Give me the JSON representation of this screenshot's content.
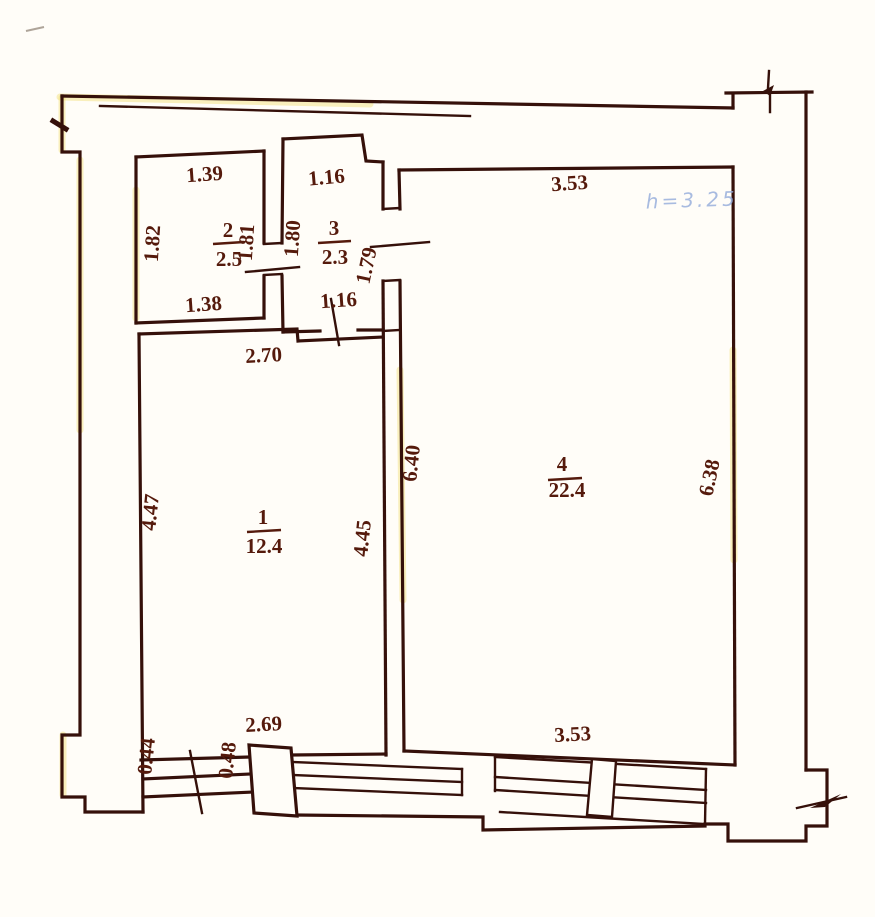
{
  "document": {
    "type": "apartment floor plan (BTI scan)"
  },
  "colors": {
    "ink": "#35100a",
    "dimension_text": "#551a0c",
    "height_note_blue": "#93abdb",
    "paper": "#fffdf8",
    "scan_highlight": "#f0dc6a"
  },
  "rooms": [
    {
      "number": "1",
      "area": "12.4",
      "dim_top": "2.70",
      "dim_left": "4.47",
      "dim_right": "4.45",
      "dim_bottom": "2.69"
    },
    {
      "number": "2",
      "area": "2.5",
      "dim_top": "1.39",
      "dim_left": "1.82",
      "dim_right": "1.81",
      "dim_bottom": "1.38"
    },
    {
      "number": "3",
      "area": "2.3",
      "dim_top": "1.16",
      "dim_left": "1.80",
      "dim_right": "1.79",
      "dim_bottom": "1.16"
    },
    {
      "number": "4",
      "area": "22.4",
      "dim_top": "3.53",
      "dim_left": "6.40",
      "dim_right": "6.38",
      "dim_bottom": "3.53"
    }
  ],
  "annotations": {
    "ceiling_height": "h=3.25",
    "entry_dim_left": "0.44",
    "entry_dim_right": "0.48"
  }
}
